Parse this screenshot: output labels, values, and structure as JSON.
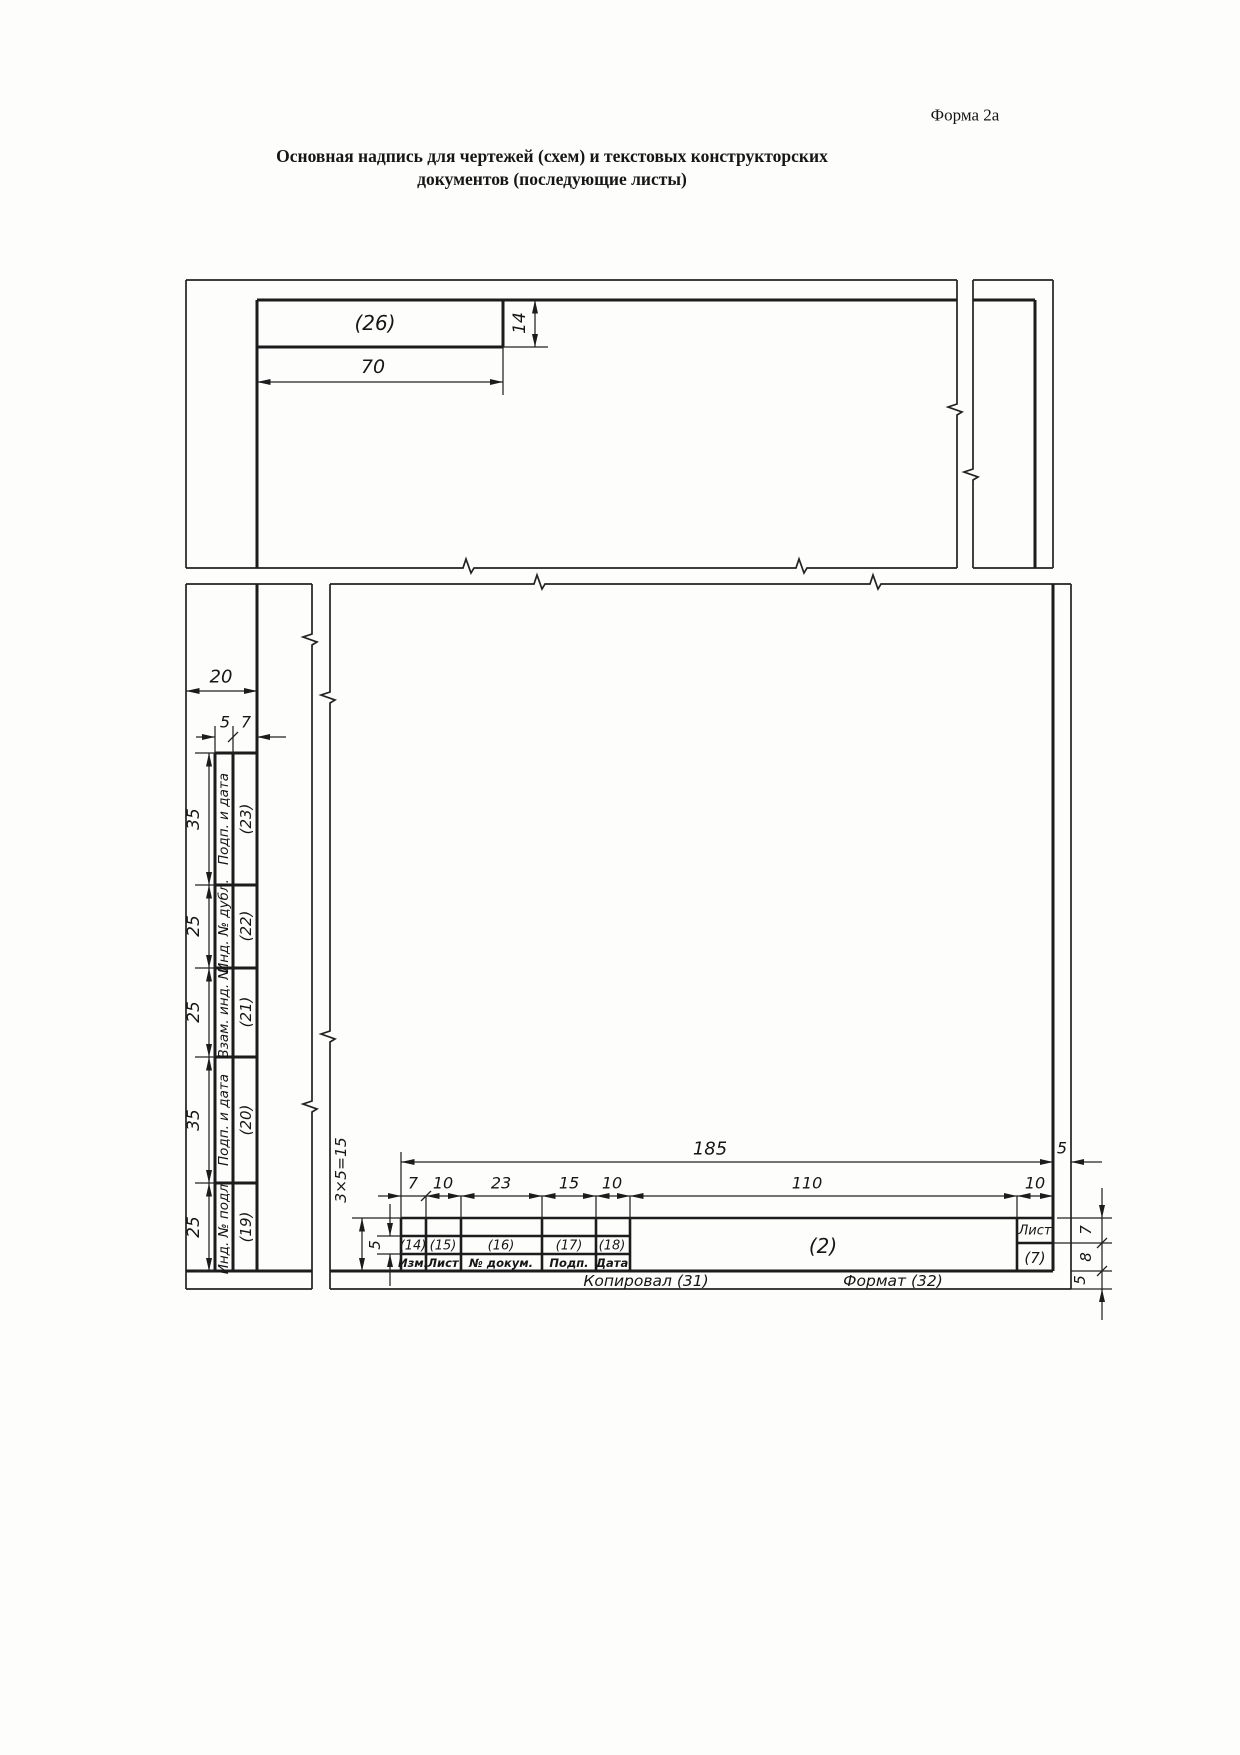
{
  "header": {
    "form_label": "Форма 2а",
    "title_line1": "Основная надпись для чертежей (схем) и текстовых конструкторских",
    "title_line2": "документов (последующие листы)"
  },
  "top_view": {
    "field_26_label": "(26)",
    "width_dim": "70",
    "height_dim": "14"
  },
  "left_columns": {
    "margin_dim": "20",
    "col5_dim": "5",
    "col7_dim": "7",
    "cells": [
      {
        "name": "Подп. и дата",
        "num": "(23)",
        "height_dim": "35"
      },
      {
        "name": "Инд. № дубл.",
        "num": "(22)",
        "height_dim": "25"
      },
      {
        "name": "Взам. инд. №",
        "num": "(21)",
        "height_dim": "25"
      },
      {
        "name": "Подп. и дата",
        "num": "(20)",
        "height_dim": "35"
      },
      {
        "name": "Инд. № подл.",
        "num": "(19)",
        "height_dim": "25"
      }
    ]
  },
  "title_block": {
    "total_width_dim": "185",
    "rows_dim": "3×5=15",
    "row_height_dim": "5",
    "right_margin_dim": "5",
    "col_dims": [
      "7",
      "10",
      "23",
      "15",
      "10",
      "110",
      "10"
    ],
    "field_numbers": [
      "(14)",
      "(15)",
      "(16)",
      "(17)",
      "(18)"
    ],
    "col_headers": [
      "Изм.",
      "Лист",
      "№ докум.",
      "Подп.",
      "Дата"
    ],
    "field_2": "(2)",
    "sheet_col_header": "Лист",
    "field_7": "(7)",
    "row7_dim": "7",
    "row8_dim": "8",
    "bottom_margin_dim": "5",
    "footer_copied": "Копировал (31)",
    "footer_format": "Формат (32)"
  }
}
